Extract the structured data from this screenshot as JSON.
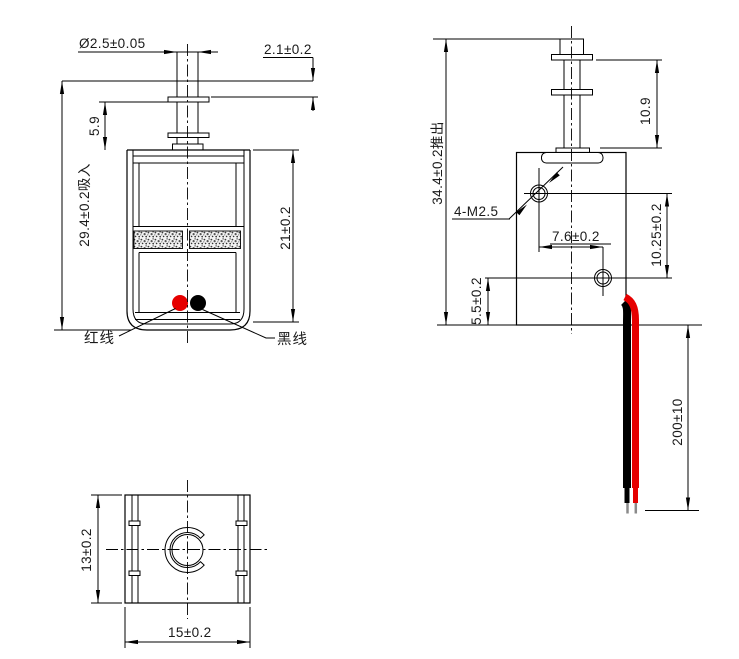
{
  "front_view": {
    "dim_plunger_diameter": "Ø2.5±0.05",
    "dim_stroke_gap": "2.1±0.2",
    "dim_collar_to_body": "5.9",
    "dim_overall_height": "29.4±0.2吸入",
    "dim_body_height": "21±0.2",
    "red_wire_label": "红线",
    "black_wire_label": "黑线"
  },
  "side_view": {
    "dim_overall_height": "34.4±0.2推出",
    "dim_plunger_extension": "10.9",
    "thread_callout": "4-M2.5",
    "dim_hole_horizontal_spacing": "7.6±0.2",
    "dim_hole_vertical_spacing": "10.25±0.2",
    "dim_hole_to_bottom": "5.5±0.2",
    "dim_lead_wire_length": "200±10"
  },
  "bottom_view": {
    "dim_depth": "13±0.2",
    "dim_width": "15±0.2"
  },
  "colors": {
    "line": "#000000",
    "text": "#1a1a1a",
    "red_wire": "#e60000",
    "black_wire": "#000000",
    "bare_wire_tip": "#8a8a8a"
  }
}
